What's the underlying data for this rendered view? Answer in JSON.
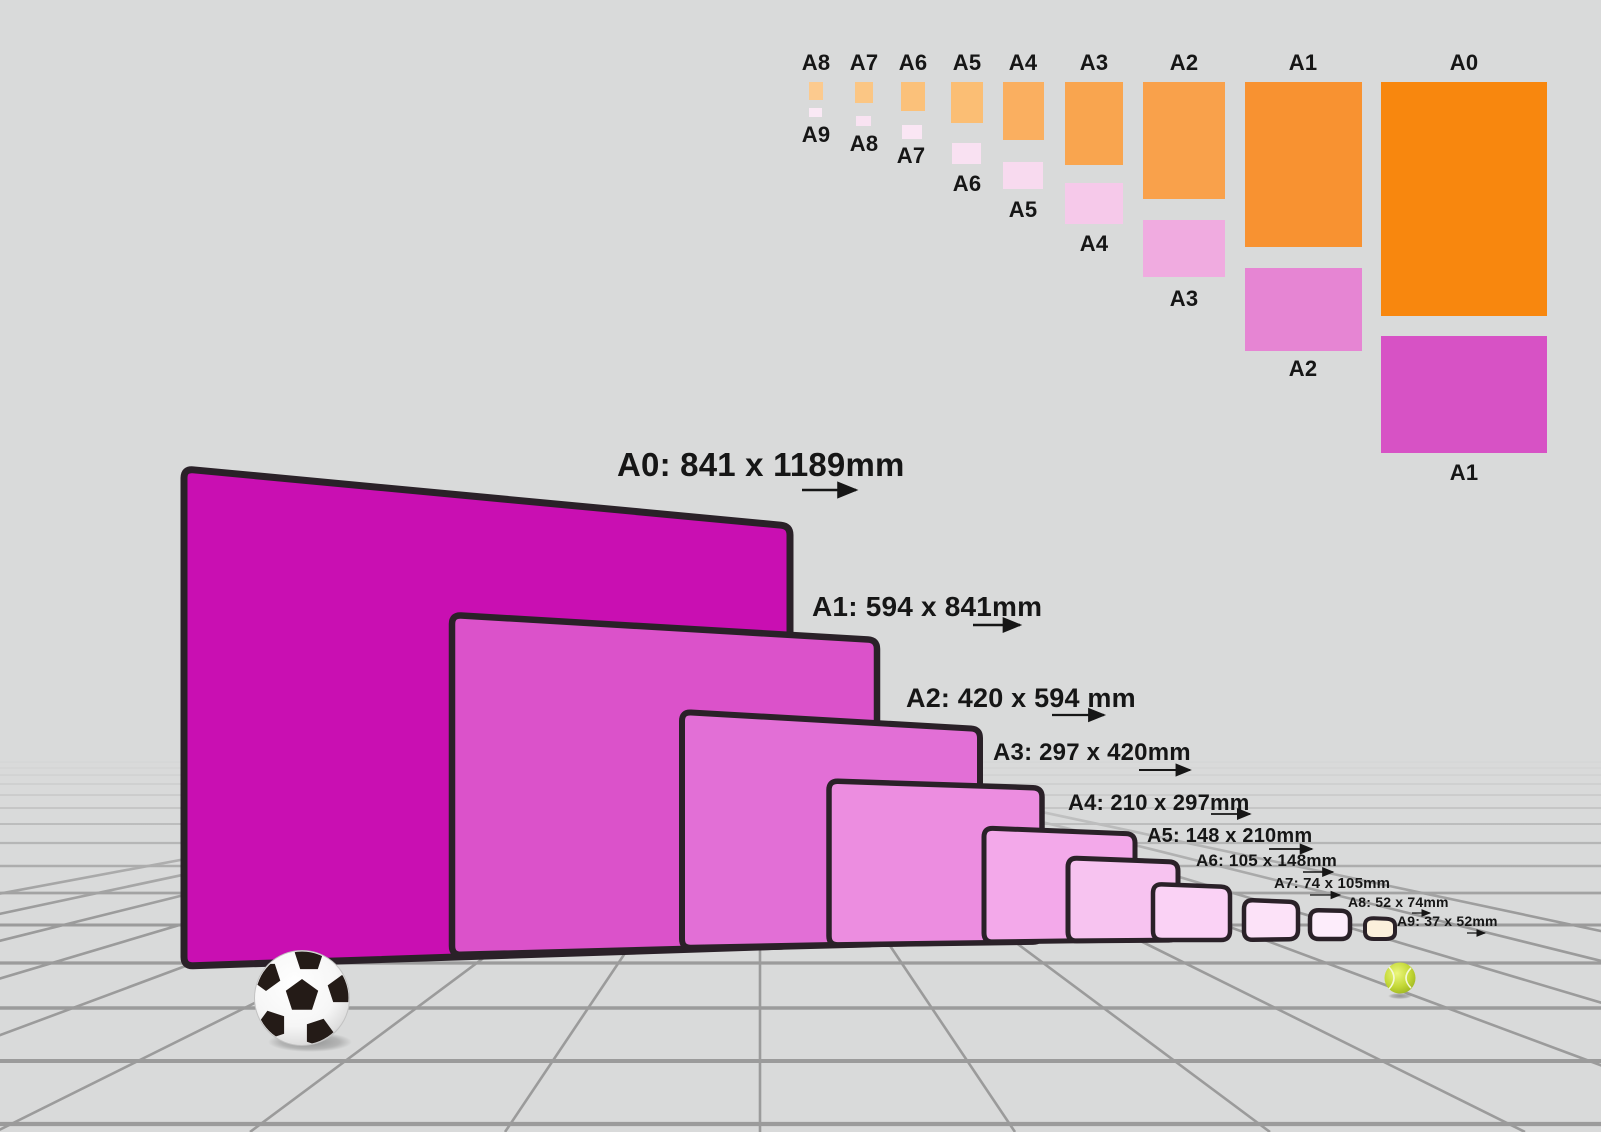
{
  "colors": {
    "background": "#D9DADA",
    "grid_line": "#9B9B9B",
    "panel_border": "#2A2128",
    "text": "#161616"
  },
  "main": {
    "panels": [
      {
        "name": "A0",
        "label": "A0: 841 x 1189mm",
        "color": "#C90FB2"
      },
      {
        "name": "A1",
        "label": "A1: 594 x 841mm",
        "color": "#DB52CA"
      },
      {
        "name": "A2",
        "label": "A2: 420 x 594 mm",
        "color": "#E26FD6"
      },
      {
        "name": "A3",
        "label": "A3: 297 x 420mm",
        "color": "#EC8DE0"
      },
      {
        "name": "A4",
        "label": "A4: 210 x 297mm",
        "color": "#F3A9EA"
      },
      {
        "name": "A5",
        "label": "A5: 148 x 210mm",
        "color": "#F7C3F0"
      },
      {
        "name": "A6",
        "label": "A6: 105 x 148mm",
        "color": "#FAD2F5"
      },
      {
        "name": "A7",
        "label": "A7: 74 x 105mm",
        "color": "#FCE2F8"
      },
      {
        "name": "A8",
        "label": "A8: 52 x 74mm",
        "color": "#FDEDFB"
      },
      {
        "name": "A9",
        "label": "A9: 37 x 52mm",
        "color": "#FBF0DC"
      }
    ]
  },
  "inset": {
    "columns": [
      {
        "top_label": "A8",
        "bottom_label": "A9",
        "portrait_color": "#FCCA8E",
        "landscape_color": "#FAE9F5"
      },
      {
        "top_label": "A7",
        "bottom_label": "A8",
        "portrait_color": "#FBC684",
        "landscape_color": "#F9E3F2"
      },
      {
        "top_label": "A6",
        "bottom_label": "A7",
        "portrait_color": "#FBC17A",
        "landscape_color": "#FAE6F4"
      },
      {
        "top_label": "A5",
        "bottom_label": "A6",
        "portrait_color": "#FBBE74",
        "landscape_color": "#F9E1F2"
      },
      {
        "top_label": "A4",
        "bottom_label": "A5",
        "portrait_color": "#FAAF60",
        "landscape_color": "#F8DAEF"
      },
      {
        "top_label": "A3",
        "bottom_label": "A4",
        "portrait_color": "#F9A54F",
        "landscape_color": "#F6C9EA"
      },
      {
        "top_label": "A2",
        "bottom_label": "A3",
        "portrait_color": "#F9A14B",
        "landscape_color": "#F0ABE0"
      },
      {
        "top_label": "A1",
        "bottom_label": "A2",
        "portrait_color": "#F89231",
        "landscape_color": "#E685D3"
      },
      {
        "top_label": "A0",
        "bottom_label": "A1",
        "portrait_color": "#F8870E",
        "landscape_color": "#D752C5"
      }
    ]
  },
  "objects": {
    "soccer_ball_patch_color": "#241B17",
    "tennis_ball_color": "#C3D836"
  }
}
